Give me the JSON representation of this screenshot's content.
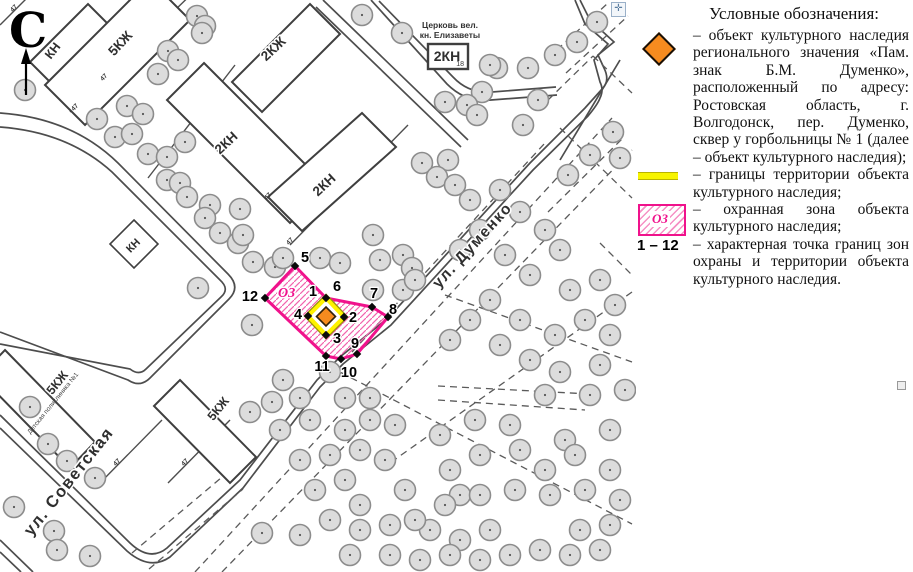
{
  "map": {
    "north_label": "С",
    "streets": {
      "dumenko": "ул. Думенко",
      "sovetskaya": "ул. Советская"
    },
    "buildings": {
      "kn": "КН",
      "five_kzh": "5КЖ",
      "two_kzh": "2КЖ",
      "two_kn": "2КН"
    },
    "church": {
      "line1": "Церковь вел.",
      "line2": "кн. Елизаветы",
      "box_label": "2КН",
      "box_number": "18"
    },
    "clinic_label": "Детская поликлиника №1",
    "plot_number": "47",
    "zone_label": "ОЗ",
    "points": [
      "1",
      "2",
      "3",
      "4",
      "5",
      "6",
      "7",
      "8",
      "9",
      "10",
      "11",
      "12"
    ]
  },
  "legend": {
    "title": "Условные обозначения:",
    "items": [
      {
        "icon": "heritage-object-diamond",
        "text": "– объект культурного наследия регионального значения «Пам. знак Б.М. Думенко», расположенный по адресу: Ростовская область, г. Волгодонск, пер. Думенко, сквер у горбольницы № 1 (далее – объект культурного наследия);"
      },
      {
        "icon": "territory-boundary-line",
        "text": "– границы территории объекта культурного наследия;"
      },
      {
        "icon": "protection-zone-hatch",
        "zone_label": "ОЗ",
        "text": "– охранная зона объекта культурного наследия;"
      },
      {
        "icon": "point-range",
        "range_label": "1 – 12",
        "text": "– характерная точка границ зон охраны и территории объекта культурного наследия."
      }
    ],
    "colors": {
      "object_orange": "#f68b1f",
      "territory_yellow": "#fff200",
      "zone_pink": "#f0128c"
    }
  }
}
